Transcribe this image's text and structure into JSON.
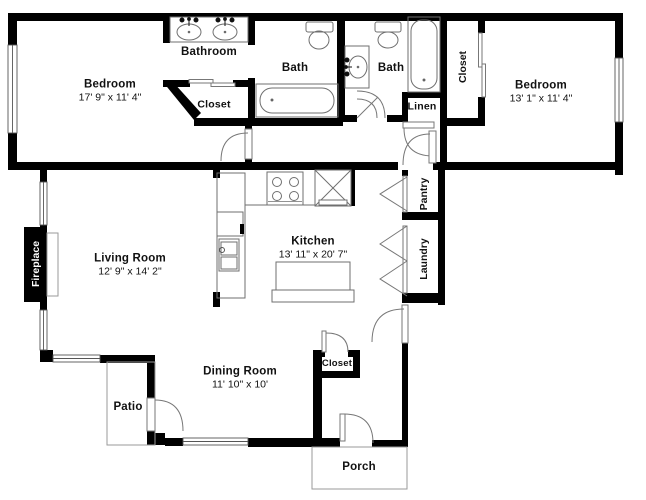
{
  "title": "2 Bedroom 2 Bath Floor Plan",
  "colors": {
    "wall": "#000000",
    "fixture": "#6f6f6f",
    "outline": "#9a9a9a",
    "background": "#ffffff"
  },
  "rooms": {
    "bathroom_vanity": {
      "label": "Bathroom"
    },
    "bedroom_left": {
      "label": "Bedroom",
      "dims": "17' 9\" x 11' 4\""
    },
    "closet_bedroom_left": {
      "label": "Closet"
    },
    "bath_left": {
      "label": "Bath"
    },
    "bath_right": {
      "label": "Bath"
    },
    "linen": {
      "label": "Linen"
    },
    "closet_bedroom_right": {
      "label": "Closet"
    },
    "bedroom_right": {
      "label": "Bedroom",
      "dims": "13' 1\" x 11' 4\""
    },
    "fireplace": {
      "label": "Fireplace"
    },
    "living_room": {
      "label": "Living Room",
      "dims": "12' 9\" x 14' 2\""
    },
    "kitchen": {
      "label": "Kitchen",
      "dims": "13' 11\" x 20' 7\""
    },
    "pantry": {
      "label": "Pantry"
    },
    "laundry": {
      "label": "Laundry"
    },
    "dining_room": {
      "label": "Dining Room",
      "dims": "11' 10\" x 10'"
    },
    "closet_entry": {
      "label": "Closet"
    },
    "patio": {
      "label": "Patio"
    },
    "porch": {
      "label": "Porch"
    }
  },
  "fixtures": [
    "double-sink-vanity",
    "toilet",
    "bathtub",
    "single-sink-vanity",
    "vertical-bathtub",
    "sliding-closet-doors",
    "stove",
    "refrigerator",
    "kitchen-sink",
    "base-cabinet",
    "kitchen-island",
    "fireplace-hearth",
    "bifold-doors",
    "door-swings",
    "windows"
  ]
}
